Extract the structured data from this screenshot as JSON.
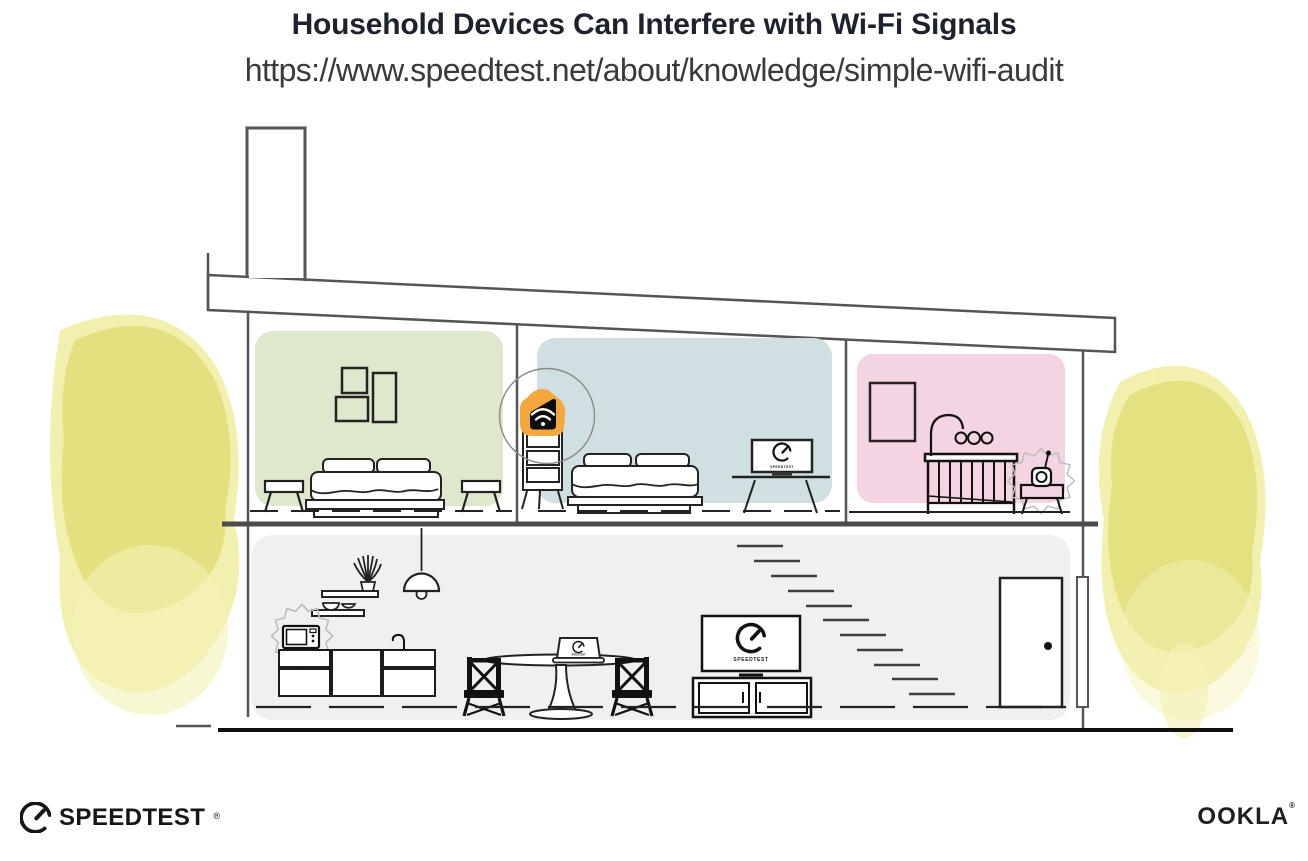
{
  "header": {
    "title": "Household Devices Can Interfere with Wi-Fi Signals",
    "url": "https://www.speedtest.net/about/knowledge/simple-wifi-audit"
  },
  "scene": {
    "tv_caption": "SPEEDTEST",
    "desk_laptop_caption": "SPEEDTEST",
    "dining_laptop_caption": "SPEEDTEST"
  },
  "footer": {
    "speedtest_wordmark": "SPEEDTEST",
    "speedtest_reg": "®",
    "ookla_wordmark": "OOKLA",
    "ookla_reg": "®"
  },
  "icons": {
    "router": "wifi-icon",
    "gauge": "speedometer-gauge-icon",
    "interference": "interference-burst-icon"
  },
  "colors": {
    "title_text": "#1D2130",
    "accent_orange": "#F4A83C",
    "room_green": "#DDE8CC",
    "room_blue": "#CFDFE2",
    "room_pink": "#F4D3E3",
    "lower_floor_gray": "#F1F0EE",
    "tree_yellow": "#E5E27E",
    "line_dark": "#222222",
    "structure_gray": "#555555"
  }
}
